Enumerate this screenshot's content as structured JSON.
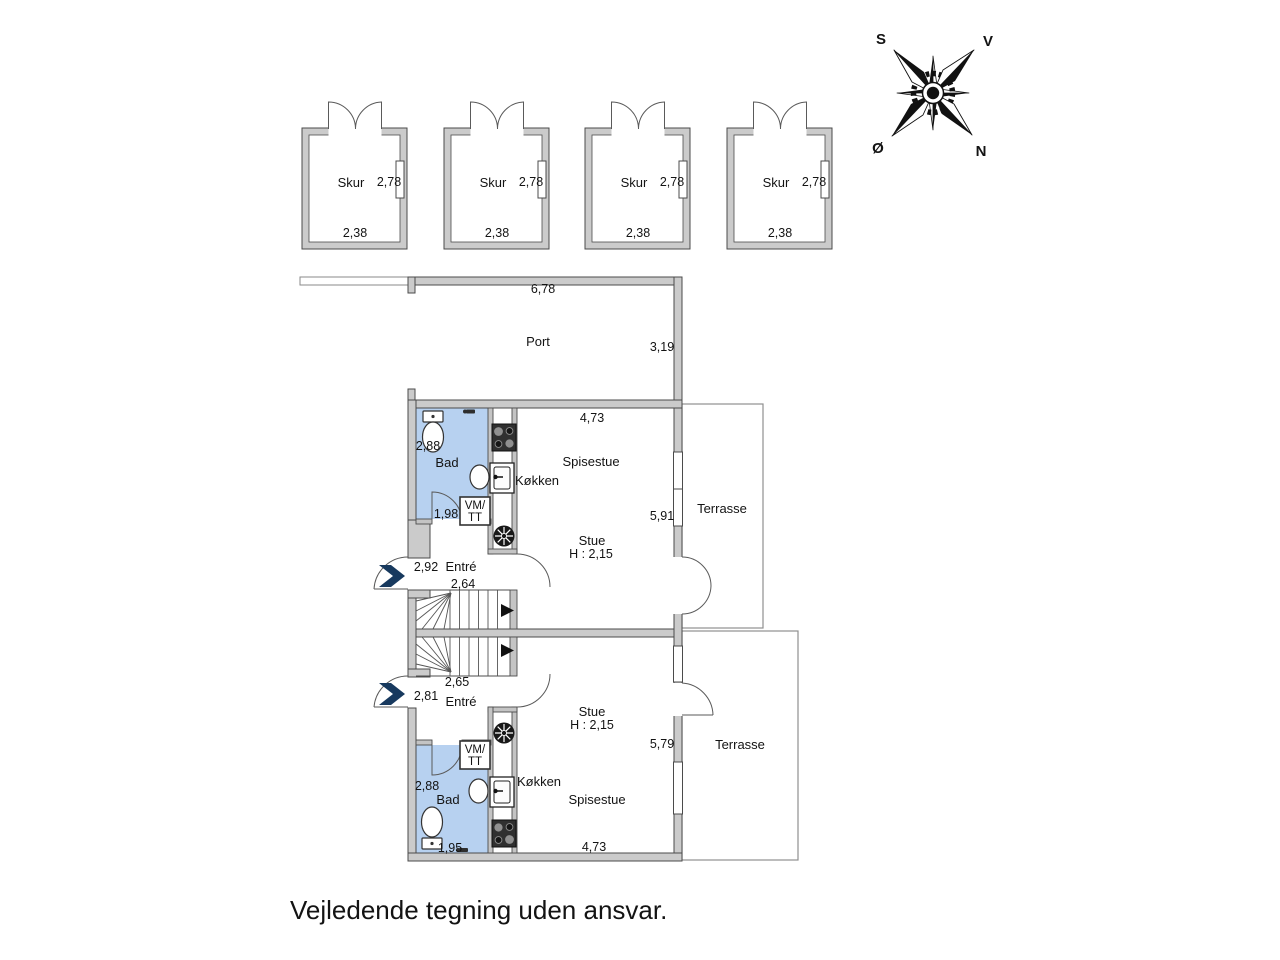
{
  "disclaimer": "Vejledende tegning uden ansvar.",
  "compass": {
    "south_label": "S",
    "west_label": "V",
    "east_label": "Ø",
    "north_label": "N"
  },
  "sheds": [
    {
      "label": "Skur",
      "depth": "2,78",
      "width": "2,38"
    },
    {
      "label": "Skur",
      "depth": "2,78",
      "width": "2,38"
    },
    {
      "label": "Skur",
      "depth": "2,78",
      "width": "2,38"
    },
    {
      "label": "Skur",
      "depth": "2,78",
      "width": "2,38"
    }
  ],
  "port": {
    "label": "Port",
    "width": "6,78",
    "depth": "3,19"
  },
  "units": {
    "upper": {
      "bathroom": {
        "label": "Bad",
        "width": "2,88",
        "door_width": "1,98"
      },
      "utility": {
        "line1": "VM/",
        "line2": "TT"
      },
      "kitchen": {
        "label": "Køkken"
      },
      "dining": {
        "label": "Spisestue",
        "width": "4,73"
      },
      "living": {
        "label": "Stue",
        "ceiling_height": "H : 2,15",
        "depth": "5,91"
      },
      "terrace": {
        "label": "Terrasse"
      },
      "entry": {
        "label": "Entré",
        "width": "2,92",
        "stair_width": "2,64"
      }
    },
    "lower": {
      "bathroom": {
        "label": "Bad",
        "width": "2,88",
        "door_width": "1,95"
      },
      "utility": {
        "line1": "VM/",
        "line2": "TT"
      },
      "kitchen": {
        "label": "Køkken"
      },
      "dining": {
        "label": "Spisestue",
        "width": "4,73"
      },
      "living": {
        "label": "Stue",
        "ceiling_height": "H : 2,15",
        "depth": "5,79"
      },
      "terrace": {
        "label": "Terrasse"
      },
      "entry": {
        "label": "Entré",
        "width": "2,81",
        "stair_width": "2,65"
      }
    }
  },
  "colors": {
    "bathroom_fill": "#b7d1f0",
    "wall_fill": "#cbcbcb",
    "arrow": "#17395e"
  }
}
